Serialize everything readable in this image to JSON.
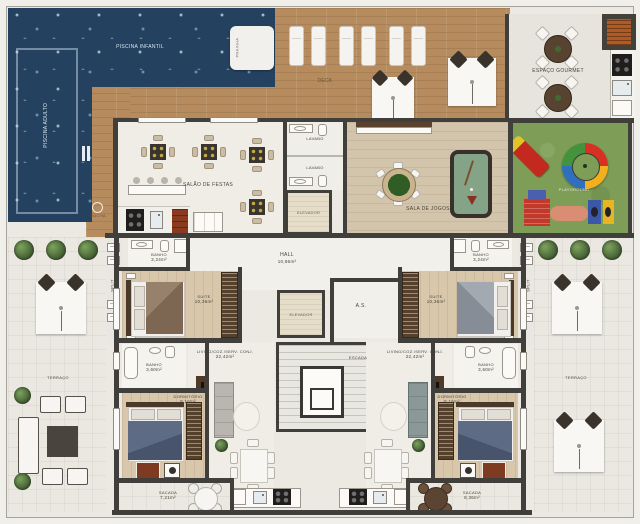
{
  "title": "Planta baixa - pavimento de lazer e apartamentos",
  "colors": {
    "water": "#24425f",
    "deck_wood": "#b68c5f",
    "grass": "#7e9e57",
    "paper": "#ebe9e2",
    "wall": "#413f3b",
    "suite_floor": "#d9c7aa",
    "slide_red": "#c3291f",
    "label_text": "#4a4539"
  },
  "amenities": {
    "pool_adult": "PISCINA ADULTO",
    "pool_kids": "PISCINA INFANTIL",
    "prainha": "PRAINHA",
    "ducha": "DUCHA",
    "deck": "DECK",
    "gourmet": "ESPAÇO GOURMET",
    "playground": "PLAYGROUND",
    "party_room": "SALÃO DE FESTAS",
    "games_room": "SALA DE JOGOS",
    "lavabo_1": "LAVABO",
    "lavabo_2": "LAVABO",
    "elevator_1": "ELEVADOR",
    "elevator_2": "ELEVADOR",
    "stairs": "ESCADA",
    "service_shaft": "A.S.",
    "hall": {
      "label": "HALL",
      "area": "10,86m²"
    },
    "terrace_left": "TERRAÇO",
    "terrace_right": "TERRAÇO"
  },
  "apartment_left": {
    "suite_bathroom": {
      "label": "BANHO",
      "area": "3,24m²"
    },
    "suite": {
      "label": "SUITE",
      "area": "10,36m²"
    },
    "ac_split": "SPLIT",
    "social_bathroom": {
      "label": "BANHO",
      "area": "3,60m²"
    },
    "living": {
      "label": "LIVING/COZ./SERV. CONJ.",
      "area": "22,42m²"
    },
    "bedroom": {
      "label": "DORMITÓRIO",
      "area": "8,16m²"
    },
    "balcony": {
      "label": "SACADA",
      "area": "7,21m²"
    }
  },
  "apartment_right": {
    "suite_bathroom": {
      "label": "BANHO",
      "area": "3,24m²"
    },
    "suite": {
      "label": "SUITE",
      "area": "10,36m²"
    },
    "ac_split": "SPLIT",
    "social_bathroom": {
      "label": "BANHO",
      "area": "3,60m²"
    },
    "living": {
      "label": "LIVING/COZ./SERV. CONJ.",
      "area": "22,42m²"
    },
    "bedroom": {
      "label": "DORMITÓRIO",
      "area": "8,16m²"
    },
    "balcony": {
      "label": "SACADA",
      "area": "8,36m²"
    }
  }
}
